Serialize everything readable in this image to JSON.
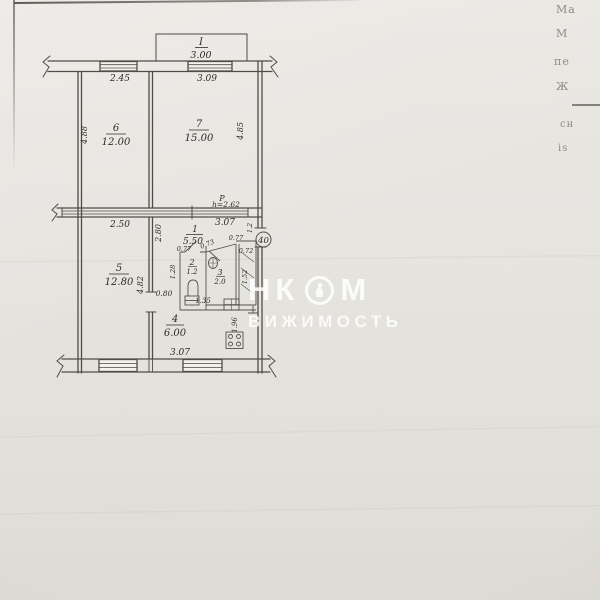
{
  "plan": {
    "apartment_number": "40",
    "balcony": {
      "number": "I",
      "area": "3.00"
    },
    "rooms": {
      "r1": {
        "number": "1",
        "area": "5.50"
      },
      "r2": {
        "number": "2",
        "area": "1.2"
      },
      "r3": {
        "number": "3",
        "area": "2.0"
      },
      "r4": {
        "number": "4",
        "area": "6.00"
      },
      "r5": {
        "number": "5",
        "area": "12.80"
      },
      "r6": {
        "number": "6",
        "area": "12.00"
      },
      "r7": {
        "number": "7",
        "area": "15.00"
      }
    },
    "dims": {
      "win_top_left": "2.45",
      "win_top_right": "3.09",
      "r6_depth": "4.88",
      "r7_depth": "4.85",
      "r5_depth": "4.82",
      "mid_left": "2.50",
      "mid_right": "3.07",
      "ceiling_label": "Р",
      "ceiling_height": "h=2.62",
      "hall_depth": "2.80",
      "entry_niche": "1.2",
      "d077a": "0.77",
      "d073": "0.73",
      "d077b": "0.77",
      "d072": "0.72",
      "d128": "1.28",
      "closet_depth": "1.52",
      "door_width": "0.80",
      "bath_width": "1.35",
      "kitchen_depth": "1.96",
      "win_bottom": "3.07"
    }
  },
  "watermark": {
    "nk": "НК",
    "m": "М",
    "line2": "ВИЖИМОСТЬ"
  },
  "margin": {
    "f1": "Ма",
    "f2": "М",
    "f3": "пе",
    "f4": "Ж",
    "f5": "сн",
    "f6": "is"
  }
}
